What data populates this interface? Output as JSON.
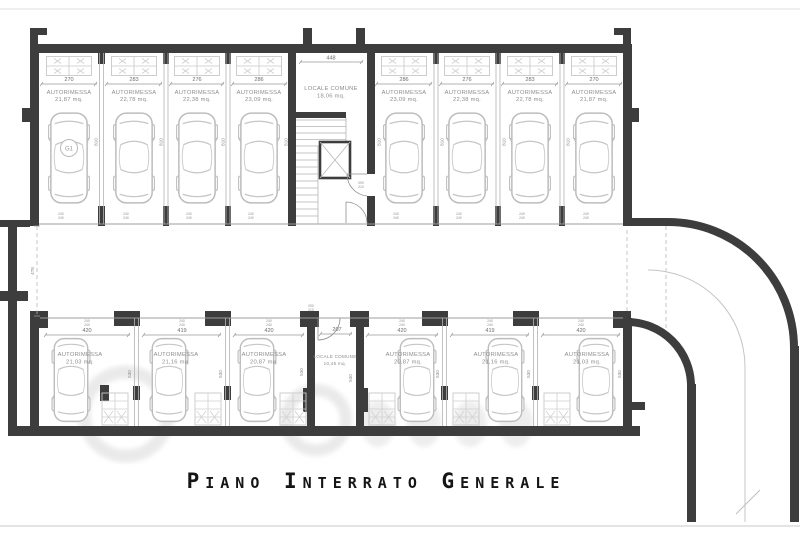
{
  "title": "Piano Interrato Generale",
  "plan": {
    "unit_label": "AUTORIMESSA",
    "locale_label": "LOCALE COMUNE",
    "top_row": [
      {
        "width": "270",
        "area": "21,87 mq."
      },
      {
        "width": "283",
        "area": "22,78 mq."
      },
      {
        "width": "276",
        "area": "22,38 mq."
      },
      {
        "width": "286",
        "area": "23,09 mq."
      },
      {
        "width": "286",
        "area": "23,09 mq."
      },
      {
        "width": "276",
        "area": "22,38 mq."
      },
      {
        "width": "283",
        "area": "22,78 mq."
      },
      {
        "width": "270",
        "area": "21,87 mq."
      }
    ],
    "bottom_row": [
      {
        "width": "420",
        "area": "21,03 mq."
      },
      {
        "width": "419",
        "area": "21,16 mq."
      },
      {
        "width": "420",
        "area": "20,87 mq."
      },
      {
        "width": "420",
        "area": "20,87 mq."
      },
      {
        "width": "419",
        "area": "21,16 mq."
      },
      {
        "width": "420",
        "area": "21,03 mq."
      }
    ],
    "locale_top": {
      "width": "448",
      "area": "18,06 mq."
    },
    "locale_bottom": {
      "width": "207",
      "area": "10,45 mq."
    },
    "top_depth": "810",
    "bottom_depth": "530",
    "corridor_width": "478",
    "opening_dim": "240",
    "door_width": "090",
    "door_height": "210",
    "car_badge": "G1"
  }
}
